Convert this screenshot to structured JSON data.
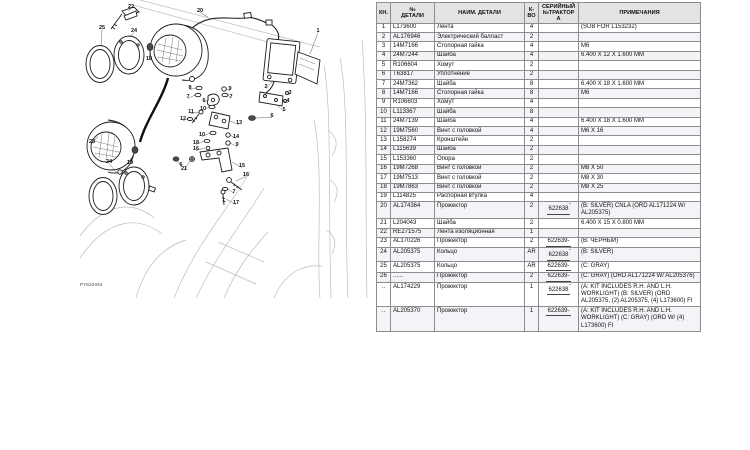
{
  "diagram": {
    "code": "PY622064",
    "callouts": [
      {
        "n": "22",
        "x": 53,
        "y": 6,
        "lx": 50,
        "ly": 11
      },
      {
        "n": "20",
        "x": 122,
        "y": 10,
        "lx": 130,
        "ly": 17
      },
      {
        "n": "25",
        "x": 24,
        "y": 27,
        "lx": 23,
        "ly": 46
      },
      {
        "n": "24",
        "x": 56,
        "y": 30,
        "lx": 52,
        "ly": 37
      },
      {
        "n": "19",
        "x": 71,
        "y": 58,
        "lx": 72,
        "ly": 51
      },
      {
        "n": "1",
        "x": 240,
        "y": 30,
        "lx": 232,
        "ly": 54
      },
      {
        "n": "2",
        "x": 188,
        "y": 86,
        "lx": 196,
        "ly": 80
      },
      {
        "n": "3",
        "x": 212,
        "y": 92,
        "lx": 207,
        "ly": 94
      },
      {
        "n": "4",
        "x": 210,
        "y": 100,
        "lx": 205,
        "ly": 101
      },
      {
        "n": "5",
        "x": 206,
        "y": 109,
        "lx": 199,
        "ly": 105
      },
      {
        "n": "6",
        "x": 194,
        "y": 115,
        "lx": 178,
        "ly": 118
      },
      {
        "n": "8",
        "x": 112,
        "y": 87,
        "lx": 118,
        "ly": 88
      },
      {
        "n": "9",
        "x": 152,
        "y": 88,
        "lx": 148,
        "ly": 89
      },
      {
        "n": "7",
        "x": 110,
        "y": 96,
        "lx": 117,
        "ly": 95
      },
      {
        "n": "7",
        "x": 153,
        "y": 96,
        "lx": 150,
        "ly": 95
      },
      {
        "n": "6",
        "x": 126,
        "y": 100,
        "lx": 131,
        "ly": 99
      },
      {
        "n": "10",
        "x": 125,
        "y": 108,
        "lx": 131,
        "ly": 107
      },
      {
        "n": "11",
        "x": 113,
        "y": 111,
        "lx": 121,
        "ly": 112
      },
      {
        "n": "12",
        "x": 105,
        "y": 118,
        "lx": 110,
        "ly": 119
      },
      {
        "n": "13",
        "x": 161,
        "y": 122,
        "lx": 152,
        "ly": 121
      },
      {
        "n": "10",
        "x": 124,
        "y": 134,
        "lx": 132,
        "ly": 133
      },
      {
        "n": "14",
        "x": 158,
        "y": 136,
        "lx": 152,
        "ly": 135
      },
      {
        "n": "9",
        "x": 159,
        "y": 144,
        "lx": 152,
        "ly": 143
      },
      {
        "n": "18",
        "x": 118,
        "y": 142,
        "lx": 126,
        "ly": 141
      },
      {
        "n": "16",
        "x": 118,
        "y": 148,
        "lx": 127,
        "ly": 148
      },
      {
        "n": "6",
        "x": 103,
        "y": 164,
        "lx": 99,
        "ly": 160
      },
      {
        "n": "21",
        "x": 106,
        "y": 168,
        "lx": 112,
        "ly": 161
      },
      {
        "n": "15",
        "x": 164,
        "y": 165,
        "lx": 154,
        "ly": 162
      },
      {
        "n": "16",
        "x": 168,
        "y": 174,
        "lx": 158,
        "ly": 181
      },
      {
        "n": "7",
        "x": 156,
        "y": 191,
        "lx": 150,
        "ly": 189
      },
      {
        "n": "17",
        "x": 158,
        "y": 202,
        "lx": 148,
        "ly": 199
      },
      {
        "n": "23",
        "x": 14,
        "y": 141,
        "lx": 20,
        "ly": 136
      },
      {
        "n": "19",
        "x": 52,
        "y": 162,
        "lx": 56,
        "ly": 153
      },
      {
        "n": "24",
        "x": 31,
        "y": 161,
        "lx": 38,
        "ly": 172
      }
    ]
  },
  "table": {
    "headers": {
      "key": "КН.",
      "part": "№\nДЕТАЛИ",
      "name": "НАИМ. ДЕТАЛИ",
      "qty": "К-\nВО",
      "serial": "СЕРИЙНЫЙ\n№ТРАКТОРА",
      "note": "ПРИМЕЧАНИЯ"
    },
    "rows": [
      {
        "key": "1",
        "part": "L173600",
        "name": "Лента",
        "qty": "4",
        "serial": "",
        "stype": "",
        "note": "(SUB FOR L153232)"
      },
      {
        "key": "2",
        "part": "AL176946",
        "name": "Электрический балласт",
        "qty": "2",
        "serial": "",
        "stype": "",
        "note": ""
      },
      {
        "key": "3",
        "part": "14M7166",
        "name": "Стопорная гайка",
        "qty": "4",
        "serial": "",
        "stype": "",
        "note": "M6"
      },
      {
        "key": "4",
        "part": "24M7244",
        "name": "Шайба",
        "qty": "4",
        "serial": "",
        "stype": "",
        "note": "6.400 X 12 X 1.600 MM"
      },
      {
        "key": "5",
        "part": "R106604",
        "name": "Хомут",
        "qty": "2",
        "serial": "",
        "stype": "",
        "note": ""
      },
      {
        "key": "6",
        "part": "T63817",
        "name": "Уплотнение",
        "qty": "2",
        "serial": "",
        "stype": "",
        "note": ""
      },
      {
        "key": "7",
        "part": "24M7362",
        "name": "Шайба",
        "qty": "8",
        "serial": "",
        "stype": "",
        "note": "6.400 X 18 X 1.600 MM"
      },
      {
        "key": "8",
        "part": "14M7166",
        "name": "Стопорная гайка",
        "qty": "8",
        "serial": "",
        "stype": "",
        "note": "M6"
      },
      {
        "key": "9",
        "part": "R106603",
        "name": "Хомут",
        "qty": "4",
        "serial": "",
        "stype": "",
        "note": ""
      },
      {
        "key": "10",
        "part": "L113367",
        "name": "Шайба",
        "qty": "8",
        "serial": "",
        "stype": "",
        "note": ""
      },
      {
        "key": "11",
        "part": "24M7139",
        "name": "Шайба",
        "qty": "4",
        "serial": "",
        "stype": "",
        "note": "6.400 X 18 X 1.600 MM"
      },
      {
        "key": "12",
        "part": "19M7560",
        "name": "Винт с головкой",
        "qty": "4",
        "serial": "",
        "stype": "",
        "note": "M6 X 16"
      },
      {
        "key": "13",
        "part": "L158274",
        "name": "Кронштейн",
        "qty": "2",
        "serial": "",
        "stype": "",
        "note": ""
      },
      {
        "key": "14",
        "part": "L115639",
        "name": "Шайба",
        "qty": "2",
        "serial": "",
        "stype": "",
        "note": ""
      },
      {
        "key": "15",
        "part": "L153360",
        "name": "Опора",
        "qty": "2",
        "serial": "",
        "stype": "",
        "note": ""
      },
      {
        "key": "16",
        "part": "19M7268",
        "name": "Винт с головкой",
        "qty": "2",
        "serial": "",
        "stype": "",
        "note": "M8 X 50"
      },
      {
        "key": "17",
        "part": "19M7513",
        "name": "Винт с головкой",
        "qty": "2",
        "serial": "",
        "stype": "",
        "note": "M8 X 30"
      },
      {
        "key": "18",
        "part": "19M7863",
        "name": "Винт с головкой",
        "qty": "2",
        "serial": "",
        "stype": "",
        "note": "M8 X 25"
      },
      {
        "key": "19",
        "part": "L114825",
        "name": "Распорная втулка",
        "qty": "4",
        "serial": "",
        "stype": "",
        "note": ""
      },
      {
        "key": "20",
        "part": "AL174364",
        "name": "Прожектор",
        "qty": "2",
        "serial": "622638",
        "stype": "to",
        "note": "(B: SILVER) CNLA (ORD AL171224 W/ AL205375)"
      },
      {
        "key": "21",
        "part": "L204043",
        "name": "Шайба",
        "qty": "2",
        "serial": "",
        "stype": "",
        "note": "6.400 X 15 X 0.800 MM"
      },
      {
        "key": "22",
        "part": "RE271575",
        "name": "Лента изоляционная",
        "qty": "1",
        "serial": "",
        "stype": "",
        "note": ""
      },
      {
        "key": "23",
        "part": "AL170226",
        "name": "Прожектор",
        "qty": "2",
        "serial": "622639-",
        "stype": "from",
        "note": "(B: ЧЕРНЫЙ)"
      },
      {
        "key": "24",
        "part": "AL205375",
        "name": "Кольцо",
        "qty": "AR",
        "serial": "622638",
        "stype": "to",
        "note": "(B: SILVER)"
      },
      {
        "key": "25",
        "part": "AL205375",
        "name": "Кольцо",
        "qty": "AR",
        "serial": "622639-",
        "stype": "from",
        "note": "(C: GRAY)"
      },
      {
        "key": "26",
        "part": "......",
        "name": "Прожектор",
        "qty": "2",
        "serial": "622639-",
        "stype": "from",
        "note": "(C: GRAY) (ORD AL171224 W/ AL205376)"
      },
      {
        "key": "..",
        "part": "AL174229",
        "name": "Прожектор",
        "qty": "1",
        "serial": "622638",
        "stype": "to",
        "note": "(A: KIT INCLUDES R.H. AND L.H. WORKLIGHT) (B: SILVER) (ORD AL205375, (2) AL205375, (4) L173600) FI"
      },
      {
        "key": "..",
        "part": "AL205370",
        "name": "Прожектор",
        "qty": "1",
        "serial": "622639-",
        "stype": "from",
        "note": "(A: KIT INCLUDES R.H. AND L.H. WORKLIGHT) (C: GRAY) (ORD W/ (4) L173600) FI"
      }
    ]
  }
}
